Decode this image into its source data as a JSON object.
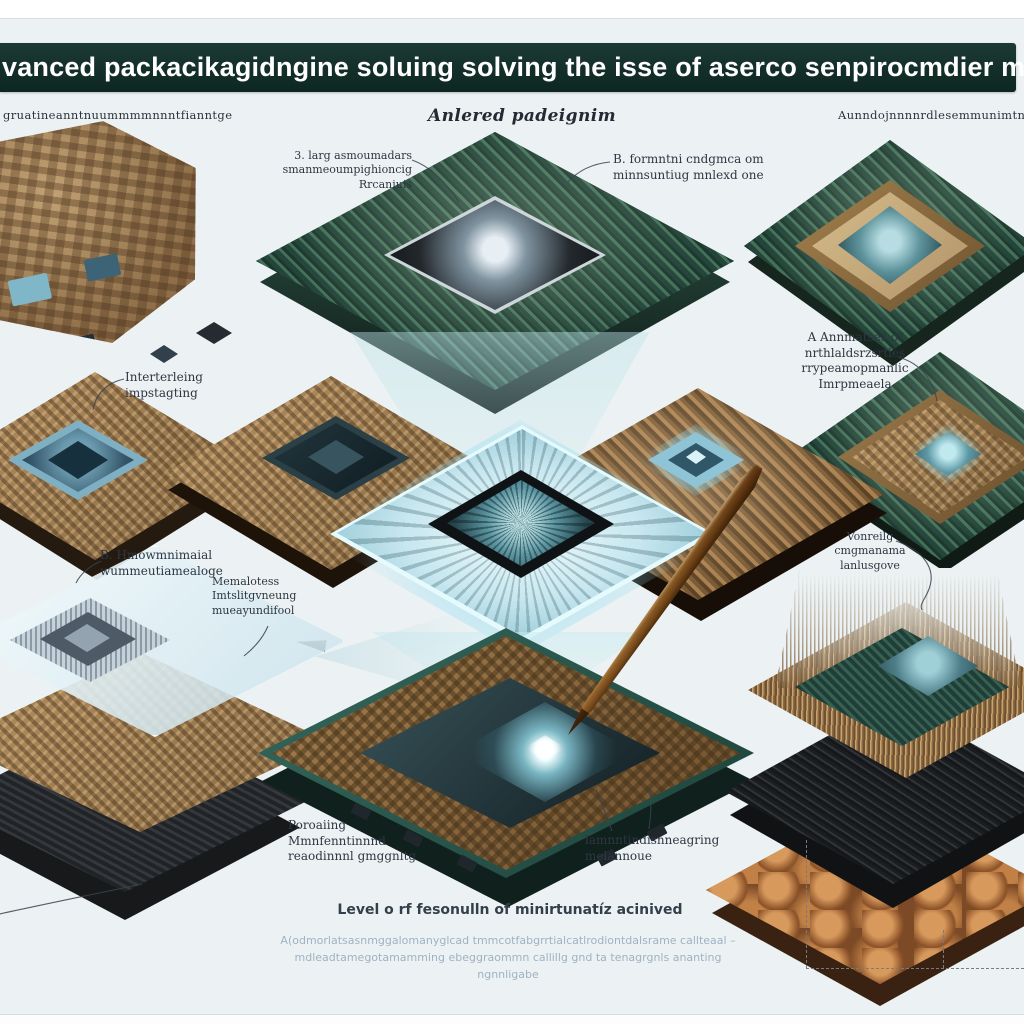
{
  "banner": {
    "title": "vanced packacikagidngine soluing solving the isse of aserco senpirocmdier minitaturization"
  },
  "column_headers": {
    "left": "gruatineanntnuummmmnnntfianntge",
    "center": "Anlered padeignim",
    "right": "Aunndojnnnnrdlesemmunimtnnnnnpp"
  },
  "callouts": [
    {
      "text": "3. larg asmoumadars\nsmanmeoumpighioncig\nRrcaniuis"
    },
    {
      "text": "B. formntni cndgmca om\nminnsuntiug mnlexd one"
    },
    {
      "text": "Interterleing\nimpstagting"
    },
    {
      "text": "A Annmatses of\nnrthlaldsrzsrtles\nrrypeamopmanlic\nImrpmeaela"
    },
    {
      "text": "B. Hmowmnimaial\nwummeutiamealoge"
    },
    {
      "text": "Memalotess\nImtslitgvneung\nmueayundifool"
    },
    {
      "text": "Vonreilg\ncmgmanama\nlanlusgove"
    },
    {
      "text": "Poroaiing\nMmnfenntinnnd\nreaodinnnl gmggnltg"
    },
    {
      "text": "lamnntindisnneagring\nmelannoue"
    }
  ],
  "footer": {
    "heading": "Level o rf fesonulln of minirtunatíz acinived",
    "paragraph": "A(odmorlatsasnmggalomanyglcad tmmcotfabgrrtialcatlrodiontdalsrame callteaal –\nmdleadtamegotamamming ebeggraommn callillg gnd ta tenagrgnls ananting\nngnnligabe"
  },
  "palette": {
    "banner_bg": "#12302a",
    "page_bg": "#ecf2f3",
    "label_text": "#2d3642",
    "muted_text": "#9fb2c2",
    "mesh_green": "#2c5040",
    "board_brown": "#a8854f",
    "glow_aqua": "#bfeef5",
    "pen_gold": "#b9894e",
    "die_dark": "#14171a",
    "tray_teal": "#2b5a50"
  }
}
